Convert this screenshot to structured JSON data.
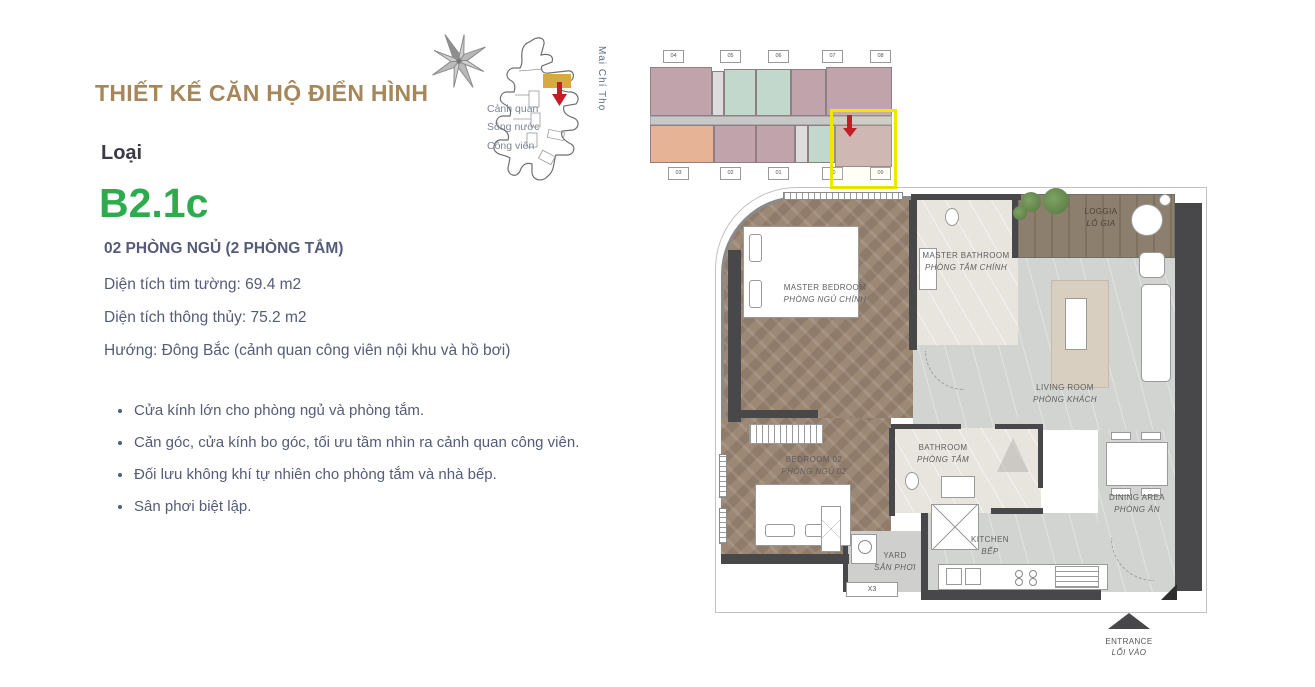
{
  "page": {
    "title": "THIẾT KẾ CĂN HỘ ĐIỂN HÌNH",
    "type_label": "Loại",
    "unit_code": "B2.1c",
    "spec_heading": "02 PHÒNG NGỦ (2 PHÒNG TẮM)",
    "specs": [
      "Diện tích tim tường: 69.4 m2",
      "Diện tích thông thủy: 75.2 m2",
      "Hướng: Đông Bắc (cảnh quan công viên nội khu và hồ bơi)"
    ],
    "features": [
      "Cửa kính lớn cho phòng ngủ và phòng tắm.",
      "Căn góc, cửa kính bo góc, tối ưu tầm nhìn ra cảnh quan công viên.",
      "Đối lưu không khí tự nhiên cho phòng tắm và nhà bếp.",
      "Sân phơi biệt lập."
    ]
  },
  "site_map": {
    "landscape_lines": [
      "Cảnh quan",
      "Sông nước",
      "Công viên"
    ],
    "street_label": "Mai Chí Thọ"
  },
  "floor_plate": {
    "top_units": [
      "04",
      "05",
      "06",
      "07",
      "08"
    ],
    "bottom_units": [
      "03",
      "02",
      "01",
      "10",
      "09"
    ]
  },
  "floor_plan": {
    "rooms": {
      "master_bedroom": {
        "en": "MASTER BEDROOM",
        "vi": "PHÒNG NGỦ CHÍNH"
      },
      "master_bathroom": {
        "en": "MASTER BATHROOM",
        "vi": "PHÒNG TẮM CHÍNH"
      },
      "loggia": {
        "en": "LOGGIA",
        "vi": "LÔ GIA"
      },
      "living_room": {
        "en": "LIVING ROOM",
        "vi": "PHÒNG KHÁCH"
      },
      "bedroom_02": {
        "en": "BEDROOM 02",
        "vi": "PHÒNG NGỦ 02"
      },
      "bathroom": {
        "en": "BATHROOM",
        "vi": "PHÒNG TẮM"
      },
      "kitchen": {
        "en": "KITCHEN",
        "vi": "BẾP"
      },
      "dining_area": {
        "en": "DINING AREA",
        "vi": "PHÒNG ĂN"
      },
      "yard": {
        "en": "YARD",
        "vi": "SÂN PHƠI"
      }
    },
    "yard_tag": "X3",
    "entrance": {
      "en": "ENTRANCE",
      "vi": "LỐI VÀO"
    }
  },
  "colors": {
    "title_gold": "#A6875C",
    "accent_green": "#2FAB4E",
    "body_text": "#565B78",
    "highlight_yellow": "#F2E600",
    "arrow_red": "#C31E25"
  }
}
